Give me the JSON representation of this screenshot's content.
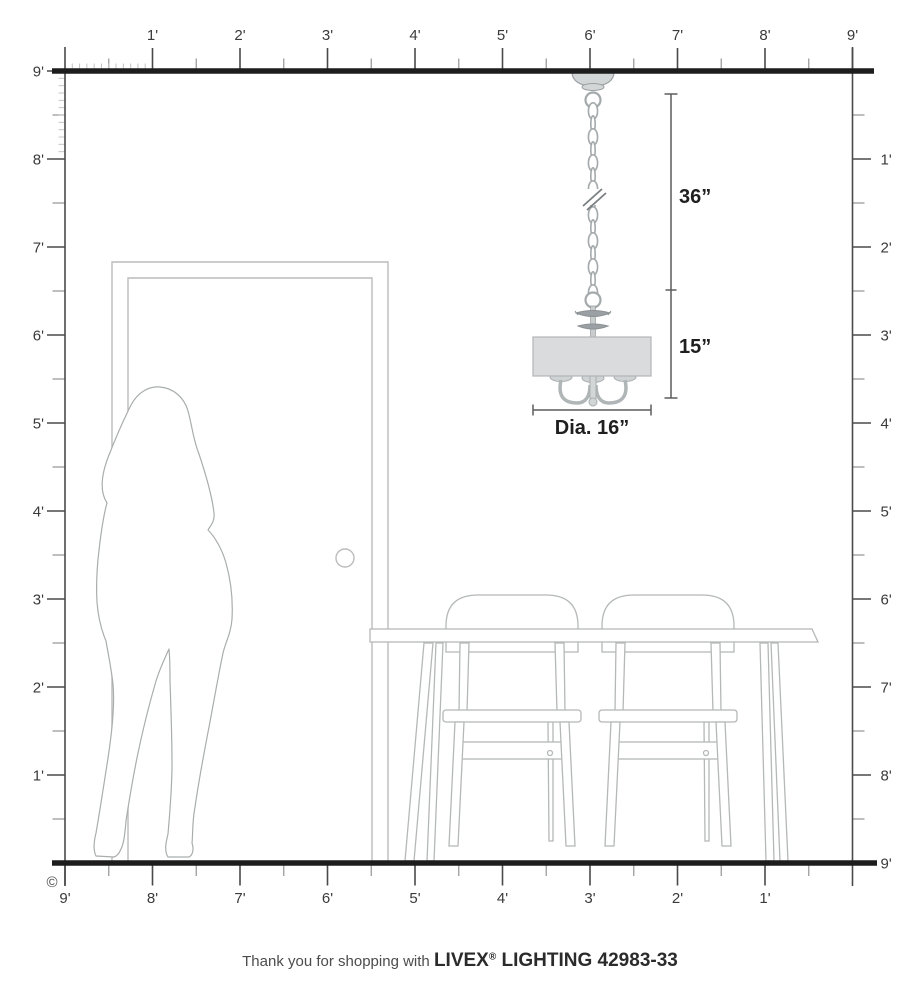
{
  "diagram": {
    "rulers": {
      "unit": "feet",
      "top": [
        "1'",
        "2'",
        "3'",
        "4'",
        "5'",
        "6'",
        "7'",
        "8'",
        "9'"
      ],
      "left": [
        "9'",
        "8'",
        "7'",
        "6'",
        "5'",
        "4'",
        "3'",
        "2'",
        "1'"
      ],
      "right": [
        "1'",
        "2'",
        "3'",
        "4'",
        "5'",
        "6'",
        "7'",
        "8'",
        "9'"
      ],
      "bottom": [
        "9'",
        "8'",
        "7'",
        "6'",
        "5'",
        "4'",
        "3'",
        "2'",
        "1'"
      ]
    },
    "annotations": {
      "chain_length": "36”",
      "fixture_height": "15”",
      "fixture_diameter": "Dia. 16”"
    },
    "copyright": "©",
    "footer": {
      "prefix": "Thank you for shopping with",
      "brand": "LIVEX",
      "registered": "®",
      "suffix": "LIGHTING 42983-33"
    },
    "colors": {
      "wall_line": "#1d1d1d",
      "ruler_line": "#4a4a4a",
      "half_tick": "#9c9c9c",
      "inch_tick": "#c4c4c4",
      "furniture_outline": "#b5b8b8",
      "silhouette_outline": "#a9adad",
      "shade_fill": "#d9dbdc",
      "metal_fill": "#d3d6d7",
      "dimension_line": "#5c5c5c"
    }
  }
}
